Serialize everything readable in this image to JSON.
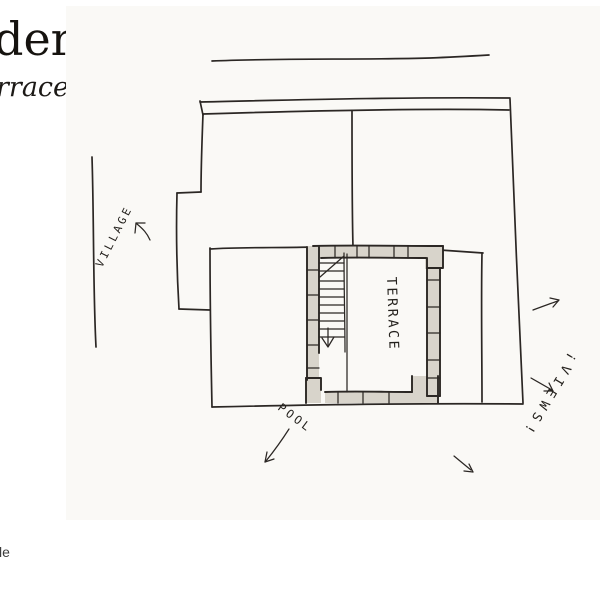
{
  "header": {
    "title_fragment": "dera",
    "subtitle_fragment": "rrace"
  },
  "footer": {
    "text_fragment": "le"
  },
  "sketch": {
    "labels": {
      "village": "VILLAGE",
      "terrace": "TERRACE",
      "pool": "POOL",
      "views": "¡VIEWS!"
    },
    "colors": {
      "ink": "#2b2724",
      "wall_fill": "#d8d4cb",
      "paper_tint": "#faf9f6"
    }
  }
}
